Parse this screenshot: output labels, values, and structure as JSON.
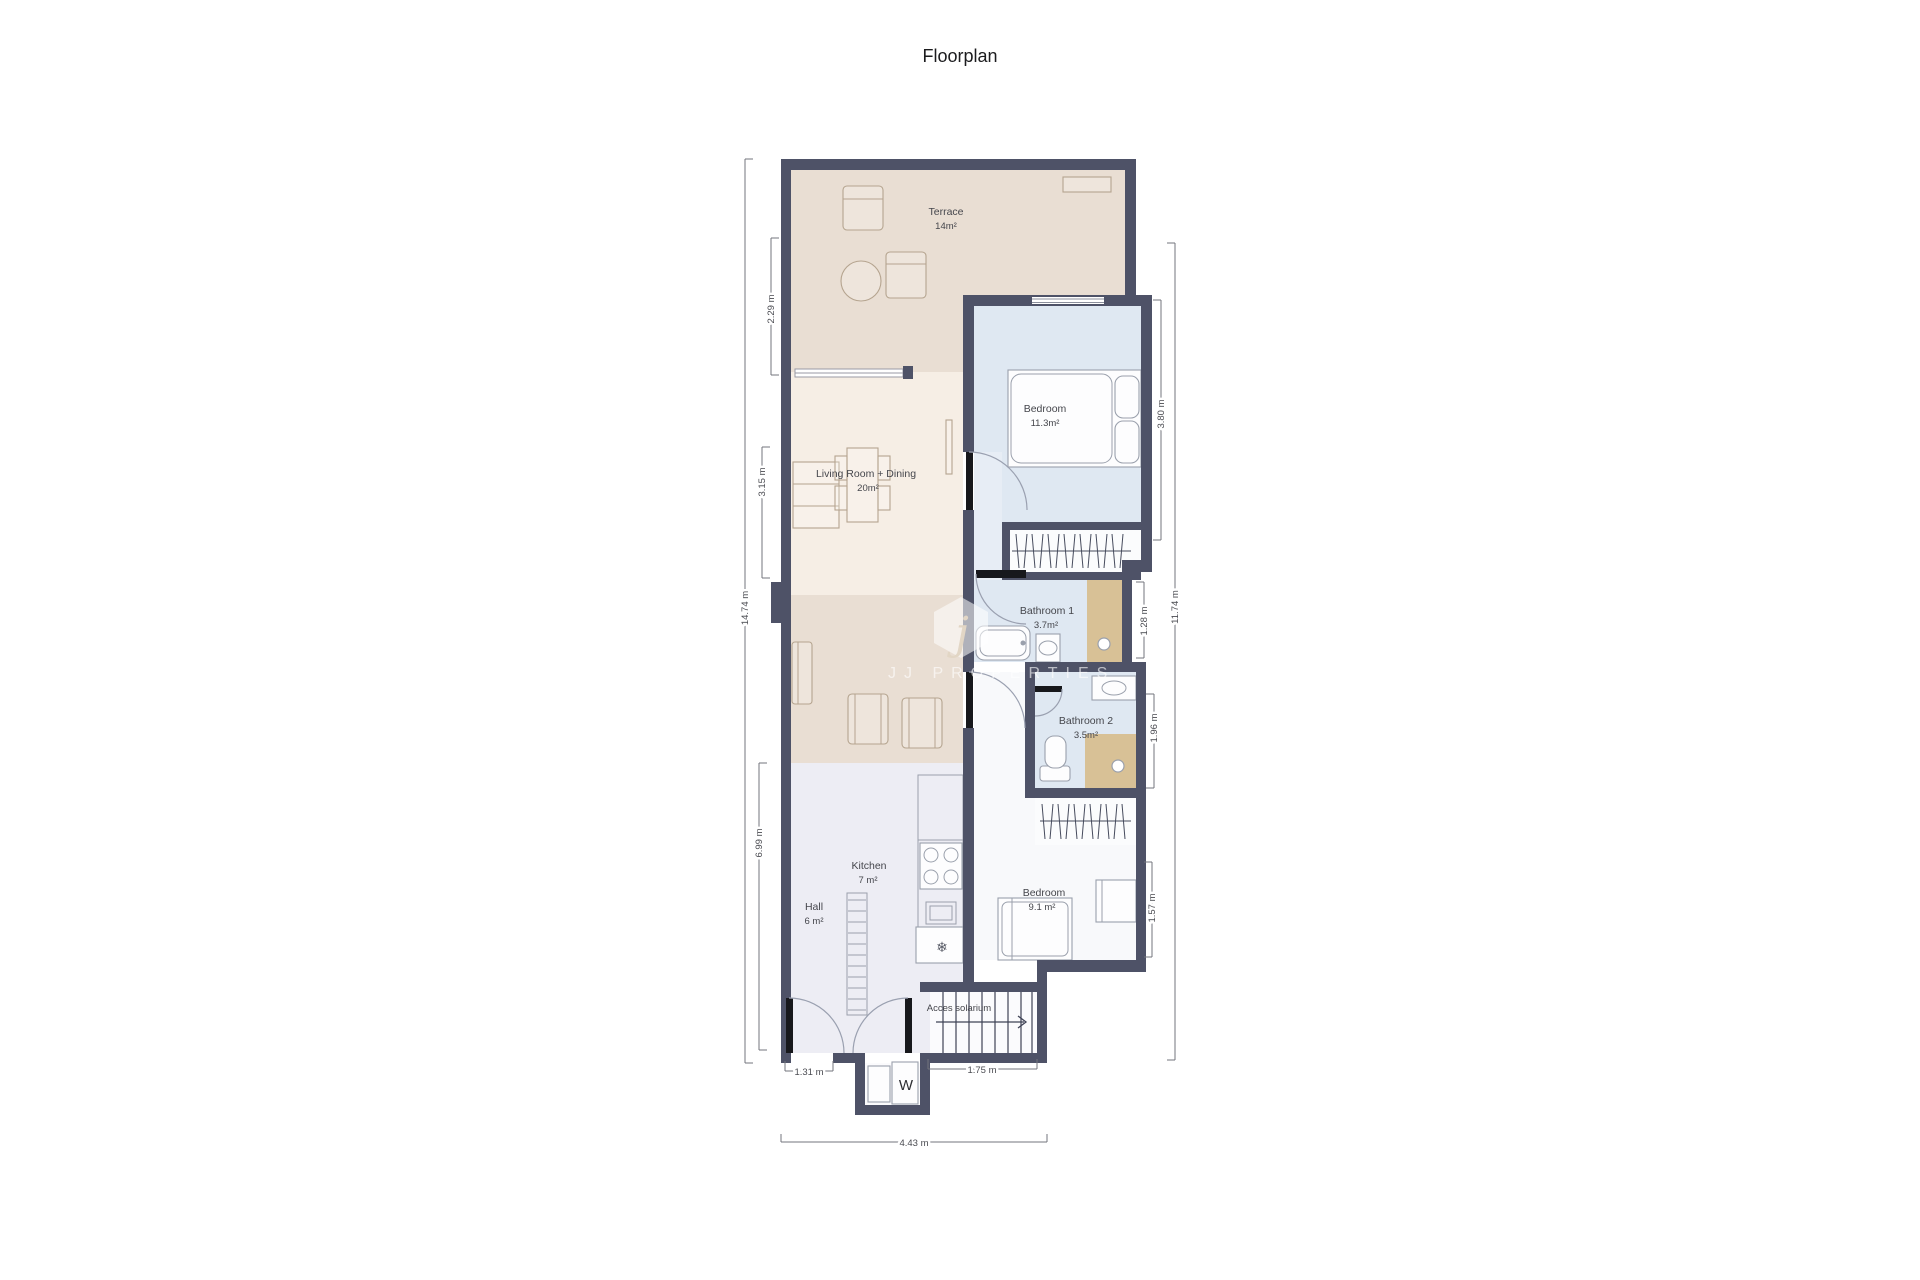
{
  "title": "Floorplan",
  "watermark": {
    "brand": "JJ PROPERTIES",
    "logo_letter": "j"
  },
  "rooms": [
    {
      "name": "Terrace",
      "area": "14m²"
    },
    {
      "name": "Bedroom",
      "area": "11.3m²"
    },
    {
      "name": "Living Room + Dining",
      "area": "20m²"
    },
    {
      "name": "Bathroom 1",
      "area": "3.7m²"
    },
    {
      "name": "Bathroom 2",
      "area": "3.5m²"
    },
    {
      "name": "Kitchen",
      "area": "7 m²"
    },
    {
      "name": "Hall",
      "area": "6 m²"
    },
    {
      "name": "Bedroom",
      "area": "9.1 m²"
    },
    {
      "name": "Acces solarium",
      "area": ""
    }
  ],
  "labels": {
    "washer": "W"
  },
  "icons": {
    "freezer": "❄"
  },
  "dims": {
    "left": [
      "14.74 m",
      "2.29 m",
      "3.15 m",
      "6.99 m"
    ],
    "right": [
      "3.80 m",
      "11.74 m",
      "1.28 m",
      "1.96 m",
      "1.57 m"
    ],
    "bottom": [
      "1.31 m",
      "1.75 m",
      "4.43 m"
    ]
  },
  "colors": {
    "wall": "#4e5267",
    "terrace_floor": "#e9ded3",
    "living_floor": "#f6eee5",
    "lounge_floor": "#e9ded3",
    "bedroom1_floor": "#dfe8f2",
    "bathroom_floor": "#dfe8f2",
    "shower_tile": "#d8c196",
    "kitchen_hall_floor": "#ededf4",
    "bedroom2_floor": "#f8f9fb",
    "dimension": "#73747c",
    "label_text": "#45464c"
  }
}
